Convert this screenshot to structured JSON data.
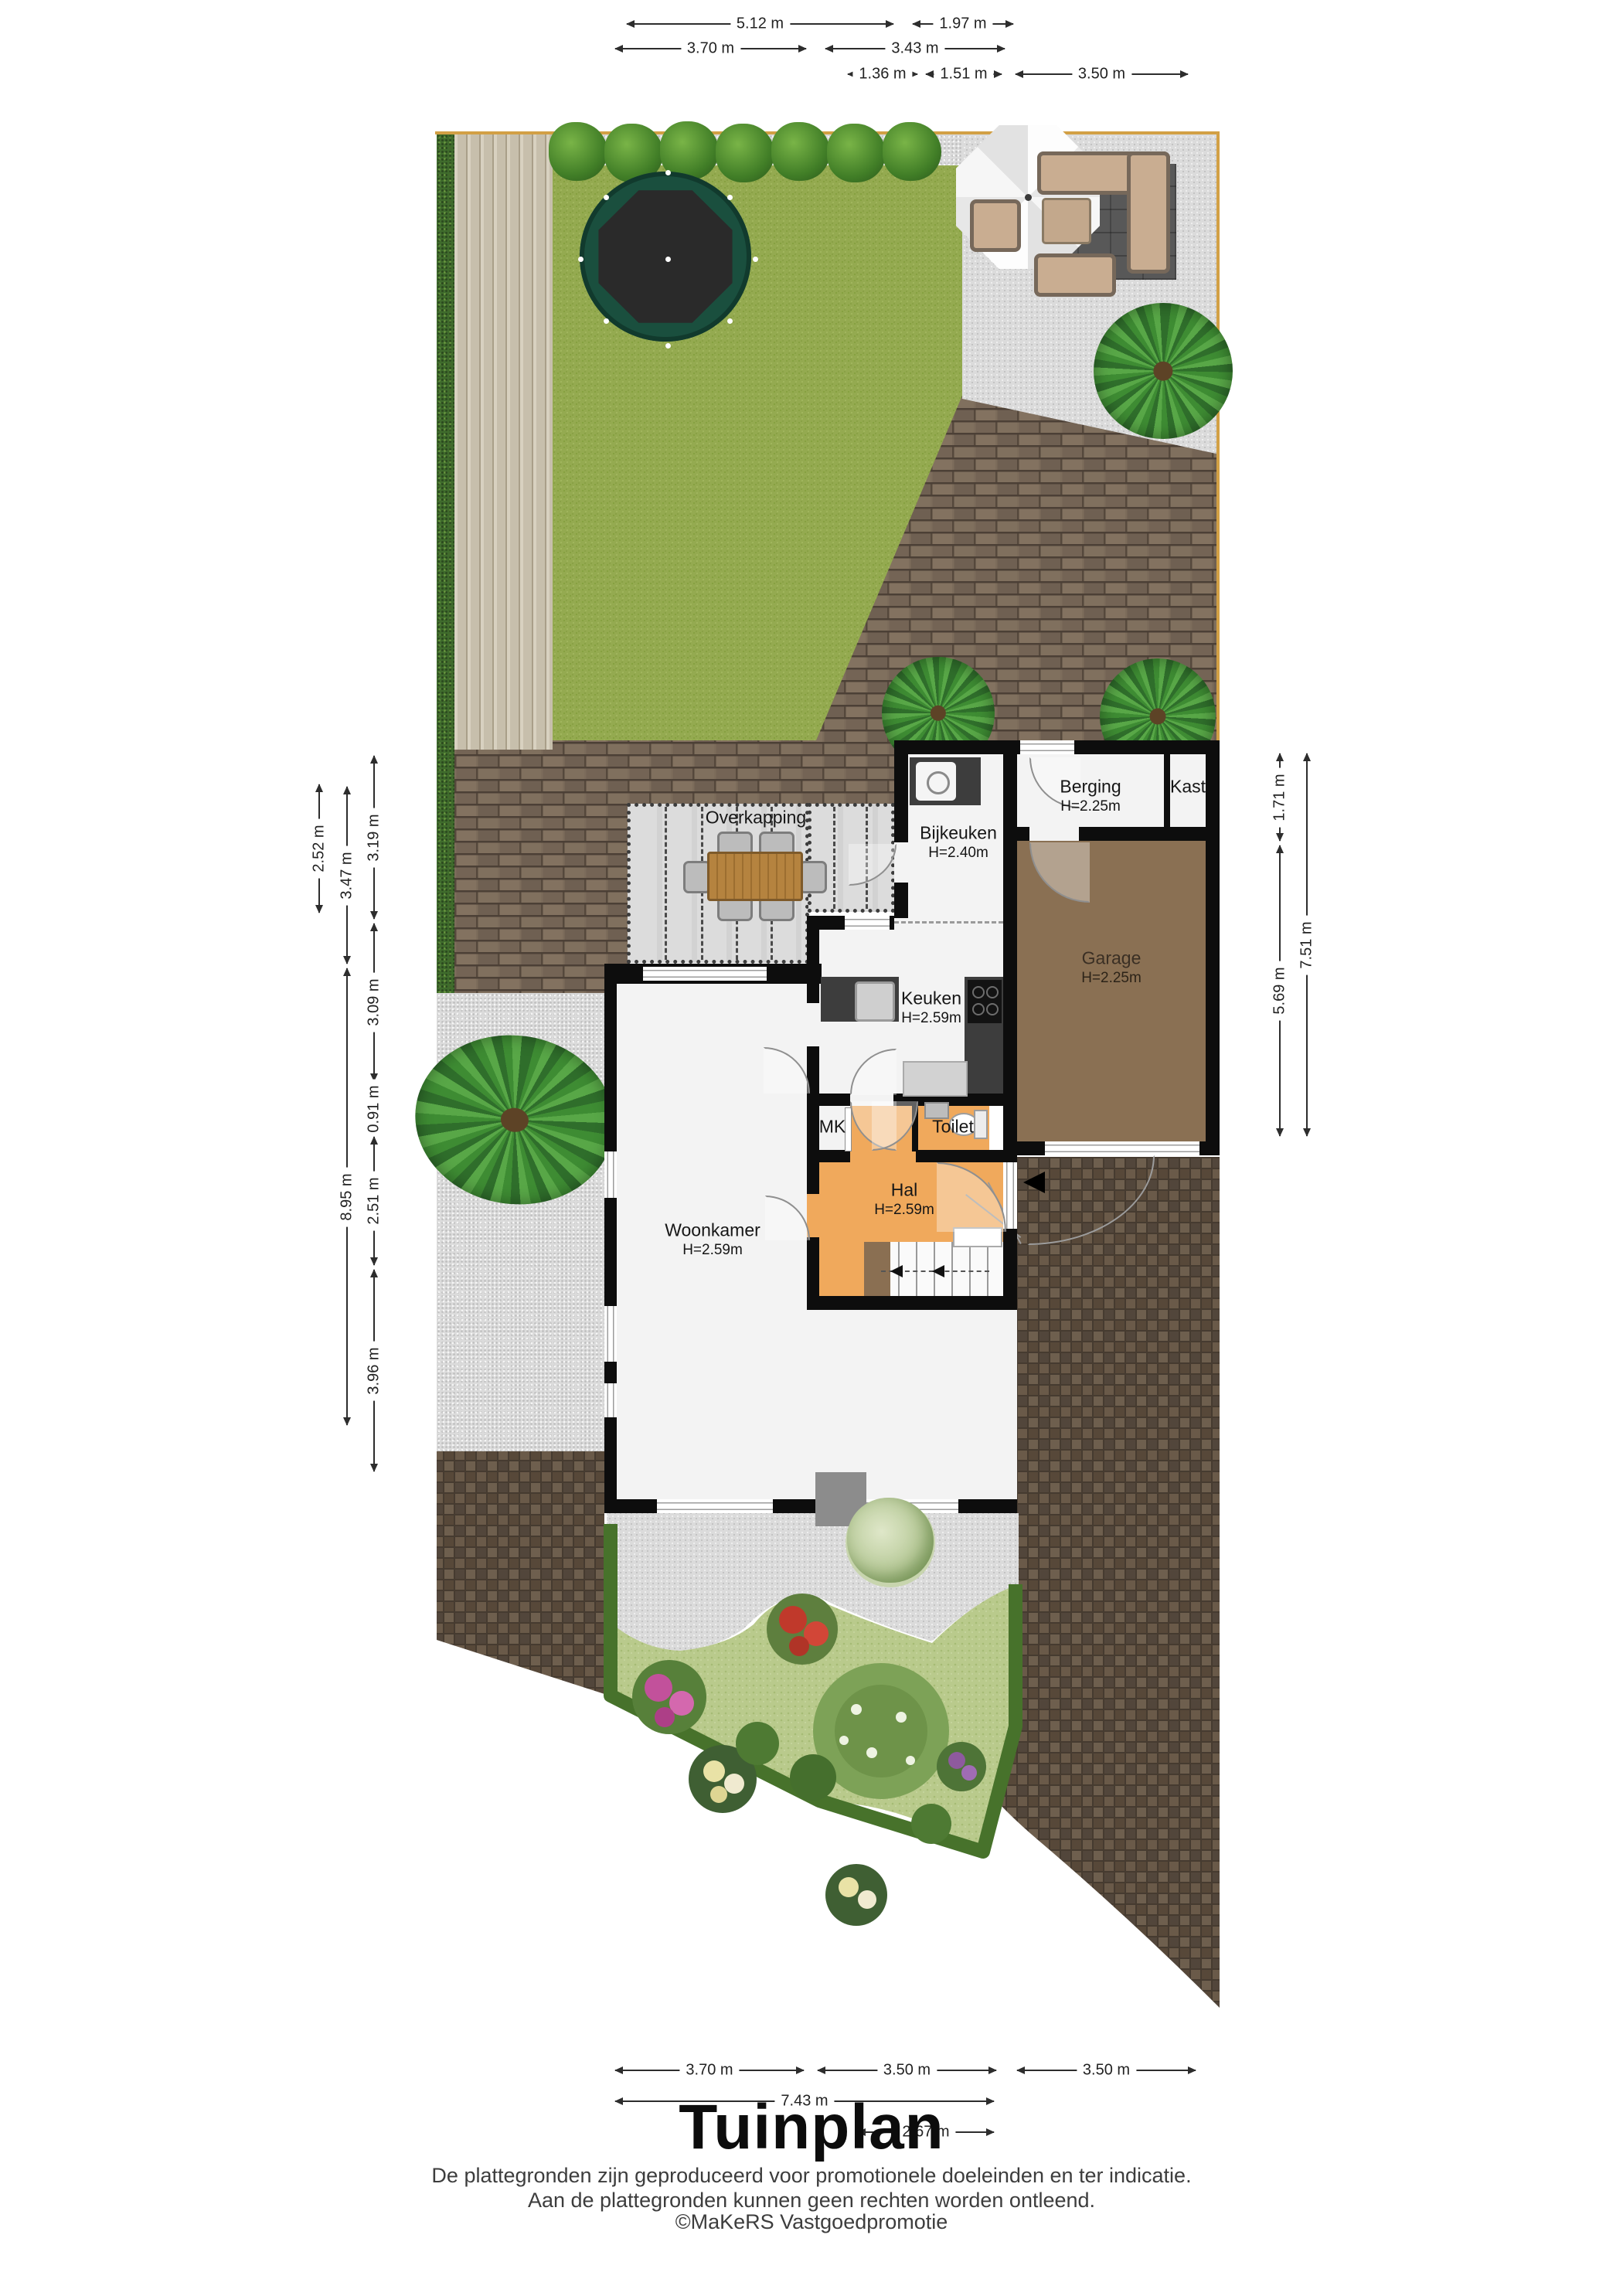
{
  "title": "Tuinplan",
  "footer": {
    "line1": "De plattegronden zijn geproduceerd voor promotionele doeleinden en ter indicatie.",
    "line2": "Aan de plattegronden kunnen geen rechten worden ontleend.",
    "line3": "©MaKeRS Vastgoedpromotie"
  },
  "rooms": {
    "overkapping": {
      "name": "Overkapping"
    },
    "bijkeuken": {
      "name": "Bijkeuken",
      "height": "H=2.40m"
    },
    "berging": {
      "name": "Berging",
      "height": "H=2.25m"
    },
    "kast": {
      "name": "Kast"
    },
    "keuken": {
      "name": "Keuken",
      "height": "H=2.59m"
    },
    "garage": {
      "name": "Garage",
      "height": "H=2.25m"
    },
    "mk": {
      "name": "MK"
    },
    "toilet": {
      "name": "Toilet"
    },
    "hal": {
      "name": "Hal",
      "height": "H=2.59m"
    },
    "woonkamer": {
      "name": "Woonkamer",
      "height": "H=2.59m"
    }
  },
  "dimensions": {
    "top": [
      "5.12 m",
      "1.97 m",
      "3.70 m",
      "3.43 m",
      "1.36 m",
      "1.51 m",
      "3.50 m"
    ],
    "left": [
      "2.52 m",
      "3.47 m",
      "8.95 m",
      "3.19 m",
      "3.09 m",
      "0.91 m",
      "2.51 m",
      "3.96 m"
    ],
    "right": [
      "1.71 m",
      "5.69 m",
      "7.51 m"
    ],
    "bottom": [
      "3.70 m",
      "3.50 m",
      "3.50 m",
      "7.43 m",
      "2.67 m"
    ]
  },
  "garden": {
    "features": [
      "hedge",
      "wood deck",
      "lawn",
      "trampoline",
      "gravel patio",
      "lounge set",
      "parasol",
      "palm trees",
      "shrub row",
      "brick terrace",
      "covered terrace with dining set",
      "flower bed",
      "driveway"
    ]
  },
  "colors": {
    "wall": "#0d0d0d",
    "hal_floor": "#f0a95c",
    "garage_floor": "#8a7053",
    "grass": "#94aa50",
    "hedge": "#3f6b2c",
    "fence": "#d2a045",
    "brick": "#7c6c5b",
    "brick_dark": "#5b4e41",
    "gravel": "#dbdbdb"
  }
}
